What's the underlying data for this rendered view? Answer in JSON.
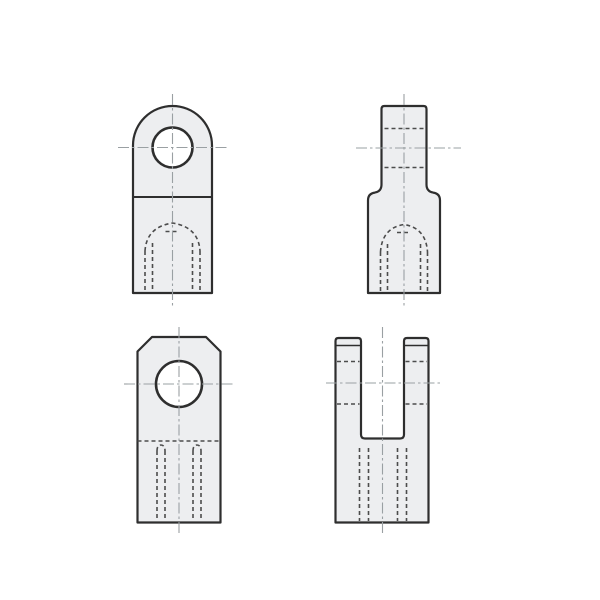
{
  "drawing": {
    "kind": "technical-orthographic-drawing",
    "subject": "rod-end fittings: eye end (top row) and fork/clevis end (bottom row), front and side views",
    "text_labels": [],
    "canvas": {
      "width": 600,
      "height": 600,
      "background": "#ffffff"
    }
  },
  "palette": {
    "background": "#ffffff",
    "part_fill": "#edeef0",
    "outline": "#2e2e2e",
    "hidden": "#4c4c4c",
    "centerline": "#9aa0a3",
    "hole_fill": "#ffffff"
  },
  "views": [
    {
      "id": "eye-end-front",
      "position": "top-left",
      "description": "front view of eye-end fitting with round head, pin hole and hidden tapped hole from bottom",
      "primitives": [
        {
          "el": "path",
          "cls": "outline fill-part",
          "dn": "eye-front-outline",
          "d": "M 133 293 L 133 145.5 A 39.5 39.5 0 0 1 212 145.5 L 212 293 Z"
        },
        {
          "el": "line",
          "cls": "joint-line",
          "dn": "eye-front-joint-line",
          "x1": 133,
          "y1": 197,
          "x2": 212,
          "y2": 197
        },
        {
          "el": "circle",
          "cls": "hole-ring",
          "dn": "eye-front-pin-hole",
          "cx": 172.5,
          "cy": 147.5,
          "r": 20
        },
        {
          "el": "path",
          "cls": "hidden-line",
          "dn": "eye-front-thread-dome",
          "d": "M 145 251 Q 146.5 227 172.5 223 Q 198.5 227 200 251"
        },
        {
          "el": "line",
          "cls": "hidden-line",
          "dn": "eye-front-drill-point-dash",
          "x1": 165.5,
          "y1": 231.5,
          "x2": 179.5,
          "y2": 231.5
        },
        {
          "el": "line",
          "cls": "hidden-line",
          "dn": "eye-front-thread-major-left",
          "x1": 145,
          "y1": 251,
          "x2": 145,
          "y2": 291.5
        },
        {
          "el": "line",
          "cls": "hidden-line",
          "dn": "eye-front-thread-major-right",
          "x1": 200,
          "y1": 251,
          "x2": 200,
          "y2": 291.5
        },
        {
          "el": "line",
          "cls": "hidden-line",
          "dn": "eye-front-thread-minor-left",
          "x1": 152.5,
          "y1": 243,
          "x2": 152.5,
          "y2": 291.5
        },
        {
          "el": "line",
          "cls": "hidden-line",
          "dn": "eye-front-thread-minor-right",
          "x1": 192.5,
          "y1": 243,
          "x2": 192.5,
          "y2": 291.5
        },
        {
          "el": "line",
          "cls": "centerline",
          "dn": "eye-front-centerline-vertical",
          "x1": 172.5,
          "y1": 94,
          "x2": 172.5,
          "y2": 308
        },
        {
          "el": "line",
          "cls": "centerline",
          "dn": "eye-front-centerline-horizontal",
          "x1": 118,
          "y1": 147.5,
          "x2": 227,
          "y2": 147.5
        }
      ]
    },
    {
      "id": "eye-end-side",
      "position": "top-right",
      "description": "side view of eye-end fitting with narrow eye tab, filleted step to body, hidden pin hole and tapped hole",
      "primitives": [
        {
          "el": "path",
          "cls": "outline fill-part",
          "dn": "eye-side-outline",
          "d": "M 368 293 L 368 200.5 Q 368 193.5 374.8 192.6 Q 381.5 191.4 381.5 184.5 L 381.5 109 Q 381.5 106 384.5 106 L 423.5 106 Q 426.5 106 426.5 109 L 426.5 184.5 Q 426.5 191.4 433.2 192.6 Q 440 193.5 440 200.5 L 440 293 Z"
        },
        {
          "el": "line",
          "cls": "hidden-line",
          "dn": "eye-side-pin-hole-top",
          "x1": 384.5,
          "y1": 128.5,
          "x2": 423.5,
          "y2": 128.5
        },
        {
          "el": "line",
          "cls": "hidden-line",
          "dn": "eye-side-pin-hole-bottom",
          "x1": 384.5,
          "y1": 167.5,
          "x2": 423.5,
          "y2": 167.5
        },
        {
          "el": "path",
          "cls": "hidden-line",
          "dn": "eye-side-thread-dome",
          "d": "M 380.5 252 Q 382 228 404 224.5 Q 426 228 427.5 252"
        },
        {
          "el": "line",
          "cls": "hidden-line",
          "dn": "eye-side-drill-point-dash",
          "x1": 397,
          "y1": 232.5,
          "x2": 411,
          "y2": 232.5
        },
        {
          "el": "line",
          "cls": "hidden-line",
          "dn": "eye-side-thread-major-left",
          "x1": 380.5,
          "y1": 252,
          "x2": 380.5,
          "y2": 291.5
        },
        {
          "el": "line",
          "cls": "hidden-line",
          "dn": "eye-side-thread-major-right",
          "x1": 427.5,
          "y1": 252,
          "x2": 427.5,
          "y2": 291.5
        },
        {
          "el": "line",
          "cls": "hidden-line",
          "dn": "eye-side-thread-minor-left",
          "x1": 387.5,
          "y1": 244,
          "x2": 387.5,
          "y2": 291.5
        },
        {
          "el": "line",
          "cls": "hidden-line",
          "dn": "eye-side-thread-minor-right",
          "x1": 420.5,
          "y1": 244,
          "x2": 420.5,
          "y2": 291.5
        },
        {
          "el": "line",
          "cls": "centerline",
          "dn": "eye-side-centerline-vertical",
          "x1": 404,
          "y1": 94,
          "x2": 404,
          "y2": 308
        },
        {
          "el": "line",
          "cls": "centerline",
          "dn": "eye-side-centerline-horizontal",
          "x1": 356,
          "y1": 148,
          "x2": 461,
          "y2": 148
        }
      ]
    },
    {
      "id": "fork-end-front",
      "position": "bottom-left",
      "description": "front view of fork/clevis end with chamfered top corners, pin hole, hidden slot bottom and tapped hole",
      "primitives": [
        {
          "el": "path",
          "cls": "outline fill-part",
          "dn": "fork-front-outline",
          "d": "M 137.5 522.5 L 137.5 351.5 L 152 337 L 206 337 L 220.5 351.5 L 220.5 522.5 Z"
        },
        {
          "el": "circle",
          "cls": "hole-ring",
          "dn": "fork-front-pin-hole",
          "cx": 179,
          "cy": 384,
          "r": 23
        },
        {
          "el": "line",
          "cls": "hidden-line",
          "dn": "fork-front-slot-bottom-hidden",
          "x1": 137.5,
          "y1": 441,
          "x2": 220.5,
          "y2": 441
        },
        {
          "el": "path",
          "cls": "hidden-line",
          "dn": "fork-front-thread-arc-left",
          "d": "M 157 451 Q 157 445 161 445 Q 165 445 165 451"
        },
        {
          "el": "path",
          "cls": "hidden-line",
          "dn": "fork-front-thread-arc-right",
          "d": "M 193 451 Q 193 445 197 445 Q 201 445 201 451"
        },
        {
          "el": "line",
          "cls": "hidden-line",
          "dn": "fork-front-thread-major-left",
          "x1": 157,
          "y1": 451,
          "x2": 157,
          "y2": 521
        },
        {
          "el": "line",
          "cls": "hidden-line",
          "dn": "fork-front-thread-major-right",
          "x1": 201,
          "y1": 451,
          "x2": 201,
          "y2": 521
        },
        {
          "el": "line",
          "cls": "hidden-line",
          "dn": "fork-front-thread-minor-left",
          "x1": 165,
          "y1": 451,
          "x2": 165,
          "y2": 521
        },
        {
          "el": "line",
          "cls": "hidden-line",
          "dn": "fork-front-thread-minor-right",
          "x1": 193,
          "y1": 451,
          "x2": 193,
          "y2": 521
        },
        {
          "el": "line",
          "cls": "centerline",
          "dn": "fork-front-centerline-vertical",
          "x1": 179,
          "y1": 327,
          "x2": 179,
          "y2": 533
        },
        {
          "el": "line",
          "cls": "centerline",
          "dn": "fork-front-centerline-horizontal",
          "x1": 124,
          "y1": 384,
          "x2": 234,
          "y2": 384
        }
      ]
    },
    {
      "id": "fork-end-side",
      "position": "bottom-right",
      "description": "side view of fork/clevis end, U-shaped prongs with chamfer lines, hidden pin hole through prongs and tapped hole below slot",
      "primitives": [
        {
          "el": "path",
          "cls": "outline fill-part",
          "dn": "fork-side-outline",
          "d": "M 335.5 522.5 L 335.5 341 Q 335.5 338 338.5 338 L 358 338 Q 361 338 361 341 L 361 434.5 Q 361 438.5 365 438.5 L 400 438.5 Q 404 438.5 404 434.5 L 404 341 Q 404 338 407 338 L 425.5 338 Q 428.5 338 428.5 341 L 428.5 522.5 Z"
        },
        {
          "el": "line",
          "cls": "thin-line",
          "dn": "fork-side-chamfer-left-prong",
          "x1": 335.5,
          "y1": 345.5,
          "x2": 361,
          "y2": 345.5
        },
        {
          "el": "line",
          "cls": "thin-line",
          "dn": "fork-side-chamfer-right-prong",
          "x1": 404,
          "y1": 345.5,
          "x2": 428.5,
          "y2": 345.5
        },
        {
          "el": "line",
          "cls": "hidden-line",
          "dn": "fork-side-pin-hole-top-left",
          "x1": 337,
          "y1": 361.5,
          "x2": 359.5,
          "y2": 361.5
        },
        {
          "el": "line",
          "cls": "hidden-line",
          "dn": "fork-side-pin-hole-bottom-left",
          "x1": 337,
          "y1": 404,
          "x2": 359.5,
          "y2": 404
        },
        {
          "el": "line",
          "cls": "hidden-line",
          "dn": "fork-side-pin-hole-top-right",
          "x1": 405.5,
          "y1": 361.5,
          "x2": 427,
          "y2": 361.5
        },
        {
          "el": "line",
          "cls": "hidden-line",
          "dn": "fork-side-pin-hole-bottom-right",
          "x1": 405.5,
          "y1": 404,
          "x2": 427,
          "y2": 404
        },
        {
          "el": "line",
          "cls": "hidden-line",
          "dn": "fork-side-thread-major-left",
          "x1": 359.5,
          "y1": 448,
          "x2": 359.5,
          "y2": 521
        },
        {
          "el": "line",
          "cls": "hidden-line",
          "dn": "fork-side-thread-major-right",
          "x1": 406.5,
          "y1": 448,
          "x2": 406.5,
          "y2": 521
        },
        {
          "el": "line",
          "cls": "hidden-line",
          "dn": "fork-side-thread-minor-left",
          "x1": 368.5,
          "y1": 448,
          "x2": 368.5,
          "y2": 521
        },
        {
          "el": "line",
          "cls": "hidden-line",
          "dn": "fork-side-thread-minor-right",
          "x1": 397.5,
          "y1": 448,
          "x2": 397.5,
          "y2": 521
        },
        {
          "el": "line",
          "cls": "centerline",
          "dn": "fork-side-centerline-vertical",
          "x1": 382.5,
          "y1": 327,
          "x2": 382.5,
          "y2": 533
        },
        {
          "el": "line",
          "cls": "centerline",
          "dn": "fork-side-centerline-horizontal",
          "x1": 326,
          "y1": 383,
          "x2": 440,
          "y2": 383
        }
      ]
    }
  ]
}
